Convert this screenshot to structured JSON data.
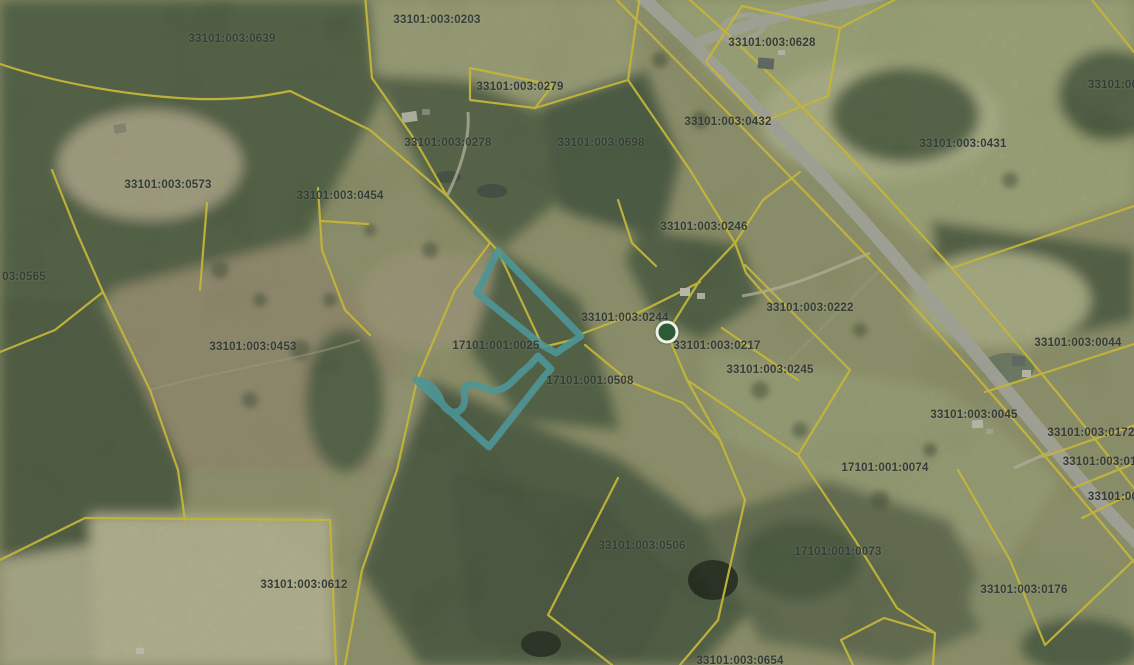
{
  "map": {
    "highlighted_parcel": {
      "id": "17101:001:0025",
      "outline_color": "#46a6ad"
    },
    "colors": {
      "parcel_line": "#e8d22f",
      "highlight": "#46a6ad",
      "label_text": "#363c39",
      "road": "#b5b3aa",
      "marker_fill": "#2c5a36"
    },
    "marker": {
      "name": "selected-point-marker",
      "x": 667,
      "y": 332
    },
    "parcel_labels": [
      {
        "id": "33101:003:0639",
        "x": 232,
        "y": 39
      },
      {
        "id": "33101:003:0203",
        "x": 437,
        "y": 20
      },
      {
        "id": "33101:003:0628",
        "x": 772,
        "y": 43
      },
      {
        "id": "33101:003:0279",
        "x": 520,
        "y": 87
      },
      {
        "id": "33101:00",
        "x": 1113,
        "y": 85
      },
      {
        "id": "33101:003:0432",
        "x": 728,
        "y": 122
      },
      {
        "id": "33101:003:0278",
        "x": 448,
        "y": 143
      },
      {
        "id": "33101:003:0698",
        "x": 601,
        "y": 143
      },
      {
        "id": "33101:003:0431",
        "x": 963,
        "y": 144
      },
      {
        "id": "33101:003:0573",
        "x": 168,
        "y": 185
      },
      {
        "id": "33101:003:0454",
        "x": 340,
        "y": 196
      },
      {
        "id": "33101:003:0246",
        "x": 704,
        "y": 227
      },
      {
        "id": "03:0565",
        "x": 24,
        "y": 277
      },
      {
        "id": "33101:003:0222",
        "x": 810,
        "y": 308
      },
      {
        "id": "33101:003:0244",
        "x": 625,
        "y": 318
      },
      {
        "id": "33101:003:0044",
        "x": 1078,
        "y": 343
      },
      {
        "id": "33101:003:0217",
        "x": 717,
        "y": 346
      },
      {
        "id": "33101:003:0453",
        "x": 253,
        "y": 347
      },
      {
        "id": "17101:001:0025",
        "x": 496,
        "y": 346
      },
      {
        "id": "33101:003:0245",
        "x": 770,
        "y": 370
      },
      {
        "id": "17101:001:0508",
        "x": 590,
        "y": 381
      },
      {
        "id": "33101:003:0045",
        "x": 974,
        "y": 415
      },
      {
        "id": "33101:003:0172",
        "x": 1091,
        "y": 433
      },
      {
        "id": "33101:003:016",
        "x": 1103,
        "y": 462
      },
      {
        "id": "17101:001:0074",
        "x": 885,
        "y": 468
      },
      {
        "id": "33101:00",
        "x": 1113,
        "y": 497
      },
      {
        "id": "33101:003:0506",
        "x": 642,
        "y": 546
      },
      {
        "id": "17101:001:0073",
        "x": 838,
        "y": 552
      },
      {
        "id": "33101:003:0612",
        "x": 304,
        "y": 585
      },
      {
        "id": "33101:003:0176",
        "x": 1024,
        "y": 590
      },
      {
        "id": "33101:003:0654",
        "x": 740,
        "y": 661
      }
    ]
  }
}
